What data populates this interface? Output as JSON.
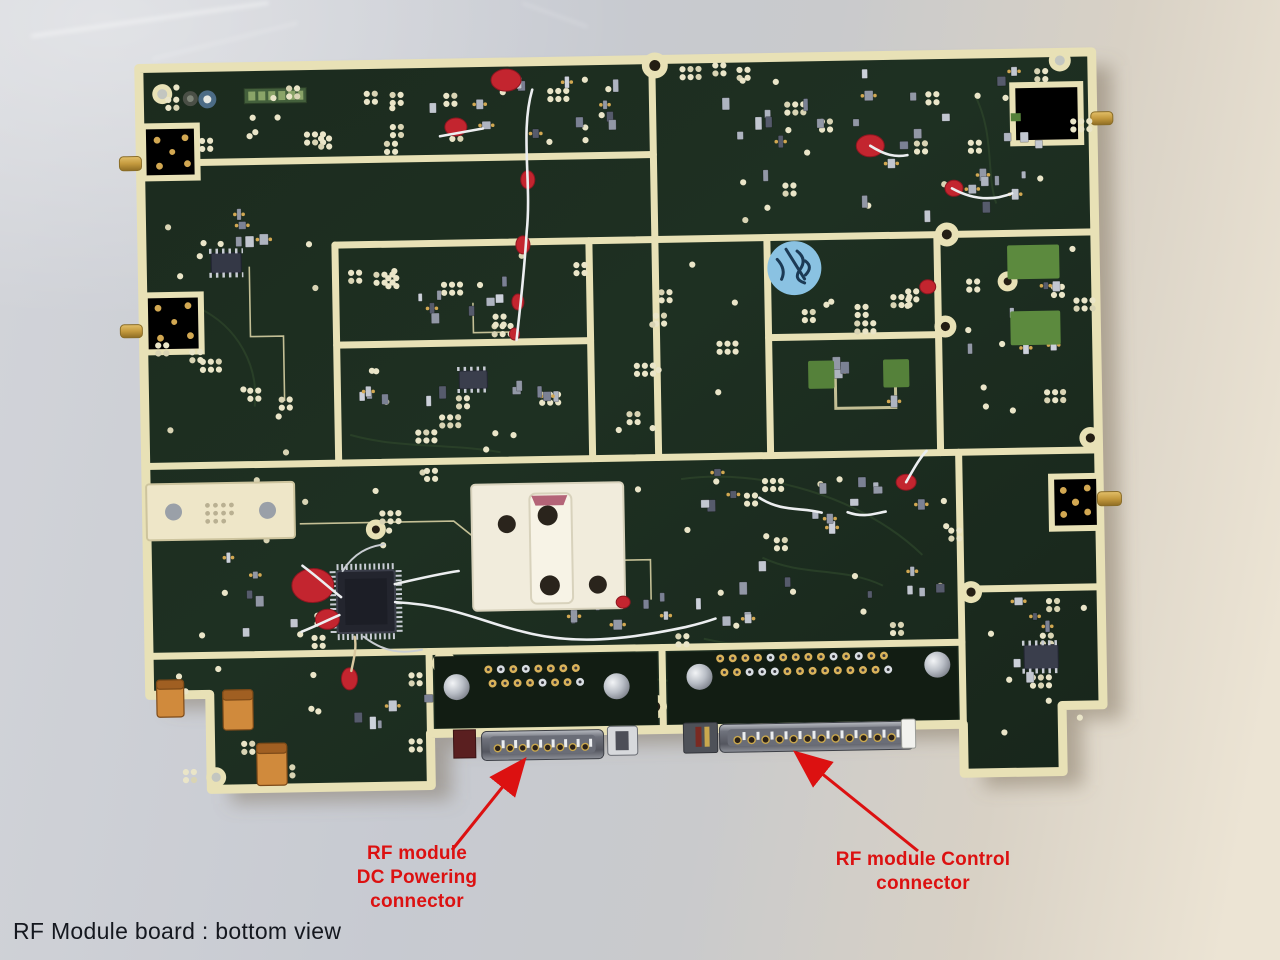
{
  "caption": {
    "text": "RF Module board : bottom view",
    "color": "#15181f"
  },
  "annotations": {
    "color": "#dc1111",
    "dc_powering": {
      "lines": [
        "RF module",
        "DC Powering",
        "connector"
      ]
    },
    "control": {
      "lines": [
        "RF module Control",
        "connector"
      ]
    }
  },
  "board": {
    "substrate_color": "#1d2d20",
    "plating_color": "#e8e1b6",
    "sticker_color": "#8ac2e2",
    "glue_dot_color": "#c3252f",
    "capacitor_color": "#d08a3c"
  }
}
